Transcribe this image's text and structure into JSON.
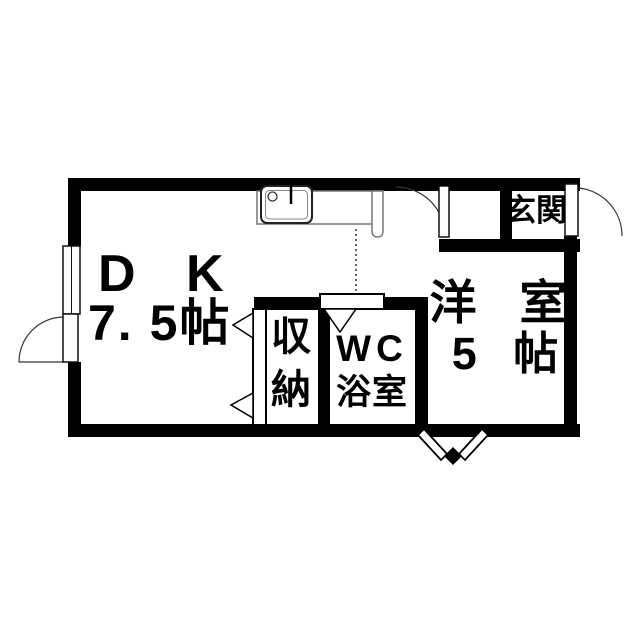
{
  "floorplan": {
    "rooms": {
      "dk": {
        "label": "D K",
        "size": "7. 5帖"
      },
      "closet": {
        "label": "収納"
      },
      "bathroom": {
        "label_wc": "WC",
        "label_bath": "浴室"
      },
      "western_room": {
        "label": "洋 室",
        "size": "5 帖"
      },
      "entrance": {
        "label": "玄関"
      }
    },
    "fixtures": {
      "kitchen_sink": "sink-with-faucet-icon",
      "kitchen_counter": "counter-icon",
      "window_left": "double-line-window-icon",
      "door_left": "swing-door-icon",
      "door_hall": "swing-door-icon",
      "door_entry": "swing-door-icon",
      "door_closet": "double-hinged-door-icon",
      "door_bathroom": "inward-door-icon",
      "door_bottom": "folding-door-icon"
    },
    "colors": {
      "wall": "#000000",
      "fixture_line": "#555555",
      "background": "#ffffff",
      "text": "#000000"
    }
  }
}
